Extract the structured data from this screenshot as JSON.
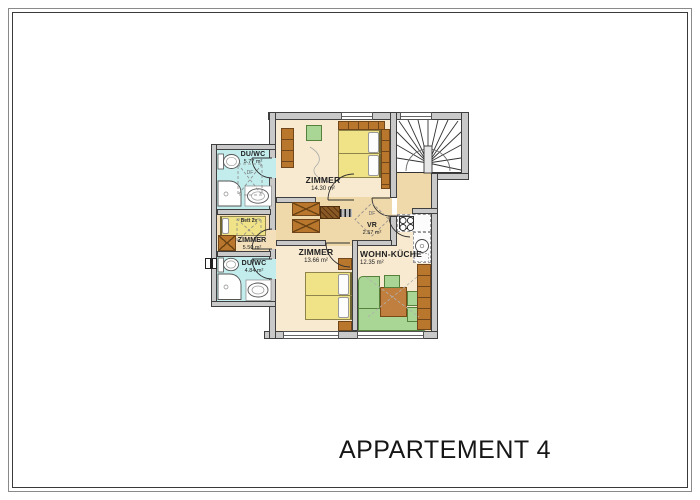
{
  "page": {
    "title": "APPARTEMENT 4"
  },
  "rooms": {
    "bath_top": {
      "name": "DU/WC",
      "area": "5.77 m²"
    },
    "bedroom_top": {
      "name": "ZIMMER",
      "area": "14.30 m²"
    },
    "bedroom_small": {
      "name": "ZIMMER",
      "area": "5.50 m²"
    },
    "bath_bottom": {
      "name": "DU/WC",
      "area": "4.84 m²"
    },
    "bedroom_bottom": {
      "name": "ZIMMER",
      "area": "13.66 m²"
    },
    "vestibule": {
      "name": "VR",
      "area": "2.57 m²"
    },
    "living_kitchen": {
      "name": "WOHN-KÜCHE",
      "area": "12.35 m²"
    }
  },
  "annotations": {
    "bed_label": "Bett 2x",
    "roof_window": "DF"
  },
  "colors": {
    "wall": "#c9c9c9",
    "bathroom_floor": "#c3ecec",
    "room_floor": "#f8ead0",
    "hall_floor": "#efd8aa",
    "bed_yellow": "#f0e286",
    "sofa_green": "#a9d694",
    "furniture_brown": "#b9772e",
    "stairs_white": "#ffffff"
  }
}
